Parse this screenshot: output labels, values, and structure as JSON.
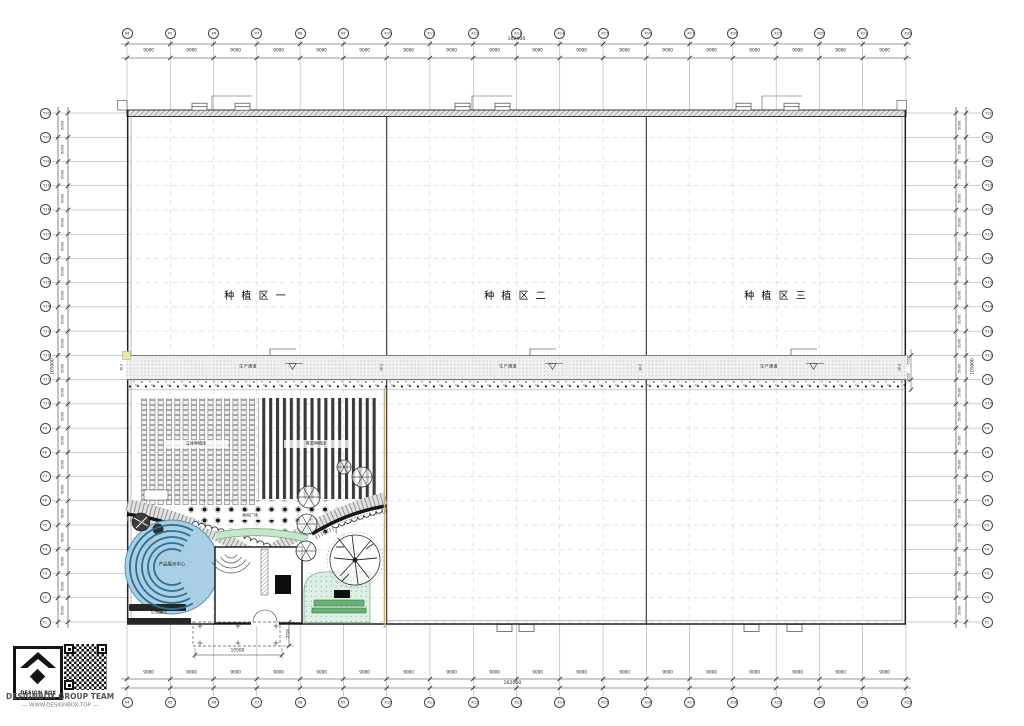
{
  "drawing": {
    "zones": [
      {
        "label": "种 植 区 一"
      },
      {
        "label": "种 植 区 二"
      },
      {
        "label": "种 植 区 三"
      }
    ],
    "corridor": {
      "label": "生产通道",
      "wall_tag": "W-2"
    },
    "garden": {
      "display_center": "产品展示中心",
      "hall": "公共展厅",
      "beds_left": "立体种植床",
      "beds_right": "育苗种植床",
      "plaza": "休闲广场"
    },
    "porch": {
      "width": "10500",
      "depth": "5700"
    },
    "side_dims": [
      "7500",
      "3000"
    ]
  },
  "axes": {
    "top": {
      "labels": [
        "X4",
        "X5",
        "X6",
        "X7",
        "X8",
        "X9",
        "X10",
        "X11",
        "X12",
        "X13",
        "X14",
        "X15",
        "X16",
        "X17",
        "X18",
        "X19",
        "X20",
        "X21",
        "X22"
      ],
      "bay": "9000",
      "total": "162000"
    },
    "bottom": {
      "labels": [
        "X4",
        "X5",
        "X6",
        "X7",
        "X8",
        "X9",
        "X10",
        "X11",
        "X12",
        "X13",
        "X14",
        "X15",
        "X16",
        "X17",
        "X18",
        "X19",
        "X20",
        "X21",
        "X22"
      ],
      "bay": "9000",
      "total": "162000"
    },
    "left": {
      "labels": [
        "Y22",
        "Y21",
        "Y20",
        "Y19",
        "Y18",
        "Y17",
        "Y16",
        "Y15",
        "Y14",
        "Y13",
        "Y12",
        "Y11",
        "Y10",
        "Y9",
        "Y8",
        "Y7",
        "Y6",
        "Y5",
        "Y4",
        "Y3",
        "Y2",
        "Y1"
      ],
      "bay": "5000",
      "total": "105000"
    },
    "right": {
      "labels": [
        "Y22",
        "Y21",
        "Y20",
        "Y19",
        "Y18",
        "Y17",
        "Y16",
        "Y15",
        "Y14",
        "Y13",
        "Y12",
        "Y11",
        "Y10",
        "Y9",
        "Y8",
        "Y7",
        "Y6",
        "Y5",
        "Y4",
        "Y3",
        "Y2",
        "Y1"
      ],
      "bay": "5000",
      "total": "105000"
    }
  },
  "colors": {
    "accent_blue": "#a9cfe4",
    "accent_green": "#def0e3",
    "boundary_yellow": "#c9b267"
  },
  "brand": {
    "logo": "DESIGN BOX",
    "team": "DESIGNBOX GROUP TEAM",
    "site": "— WWW.DESIGNBOX.TOP —"
  }
}
